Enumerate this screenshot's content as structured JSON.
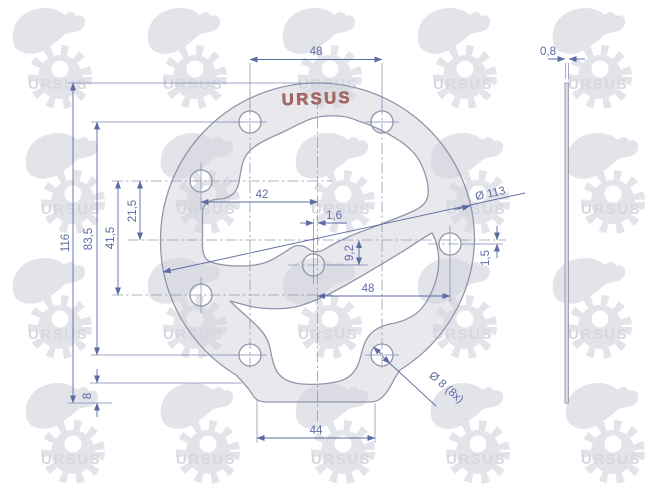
{
  "drawing": {
    "title": "gasket technical drawing",
    "logo": "URSUS",
    "watermark": "URSUS",
    "colors": {
      "dimension": "#5c6ba3",
      "outline": "#9196a9",
      "gasket_fill": "#e9e9ef",
      "logo_red": "#a86a63",
      "watermark_gray": "#e3e3ea"
    },
    "dims": {
      "top_hole_spacing": "48",
      "thickness": "0,8",
      "overall_height": "116",
      "hole_row_spacing": "83,5",
      "left_hole_spacing": "41,5",
      "left_hole_to_center": "21,5",
      "left_hole_to_axis": "42",
      "center_offset_x": "1,6",
      "center_offset_y": "9,2",
      "axis_to_right_hole": "48",
      "right_hole_offset": "1,5",
      "outer_diameter": "Ø 113",
      "bottom_step_height": "8",
      "bottom_flat_width": "44",
      "bolt_holes": "Ø 8 (8x)"
    }
  }
}
